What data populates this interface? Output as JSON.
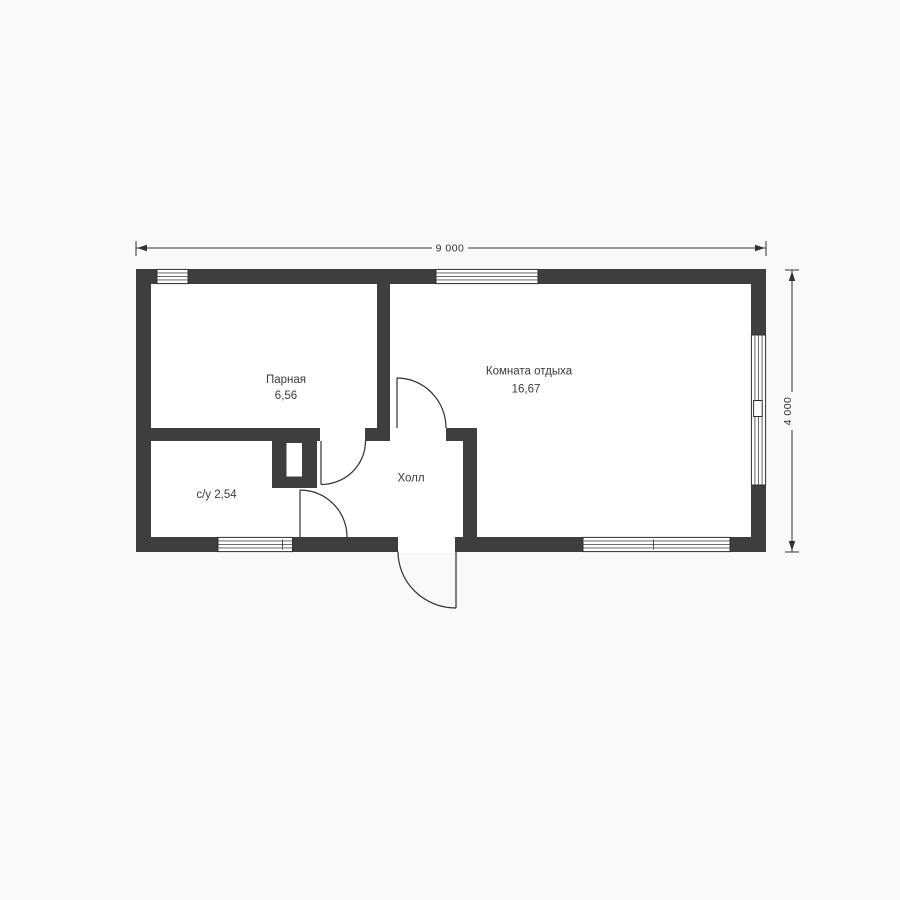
{
  "plan": {
    "type": "floor-plan",
    "rooms": [
      {
        "label": "Парная",
        "area": "6,56"
      },
      {
        "label": "Комната отдыха",
        "area": "16,67"
      },
      {
        "label": "с/у 2,54"
      },
      {
        "label": "Холл"
      }
    ],
    "dimensions": {
      "width_label": "9 000",
      "height_label": "4 000"
    },
    "colors": {
      "wall": "#3e3e3e",
      "line": "#2e2e2e",
      "background": "#f9f9f9",
      "floor": "#ffffff"
    }
  }
}
